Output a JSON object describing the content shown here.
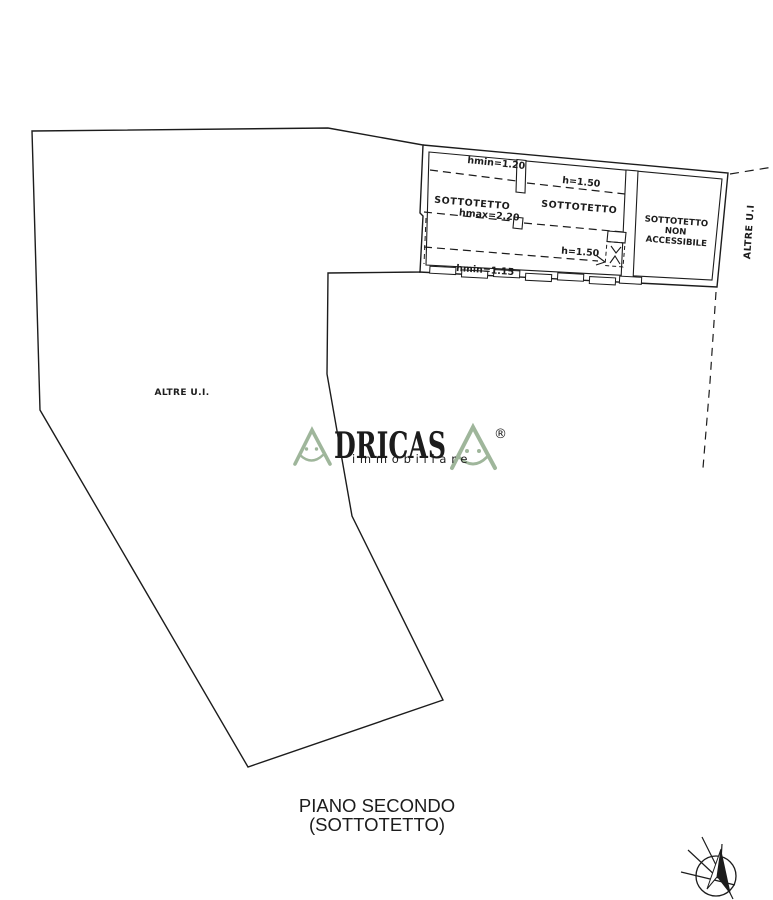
{
  "plan": {
    "attic_rooms": {
      "left_label": "SOTTOTETTO",
      "middle_label": "SOTTOTETTO",
      "right_label_line1": "SOTTOTETTO",
      "right_label_line2": "NON",
      "right_label_line3": "ACCESSIBILE"
    },
    "height_annotations": {
      "hmin_top": "hmin=1.20",
      "h_upper": "h=1.50",
      "hmax": "hmax=2.20",
      "h_lower": "h=1.50",
      "hmin_bottom": "hmin=1.15"
    },
    "other_units_main": "ALTRE U.I.",
    "other_units_side": "ALTRE U.I",
    "caption": {
      "line1": "PIANO SECONDO",
      "line2": "(SOTTOTETTO)"
    }
  },
  "watermark": {
    "brand_full": "ADRICASA",
    "brand_letters": "DRICAS",
    "tagline": "immobiliare",
    "registered_mark": "®",
    "brand_color": "#9fb69b",
    "tagline_color": "#a9c3d6"
  },
  "colors": {
    "ink": "#1c1c1c",
    "background": "#ffffff"
  }
}
